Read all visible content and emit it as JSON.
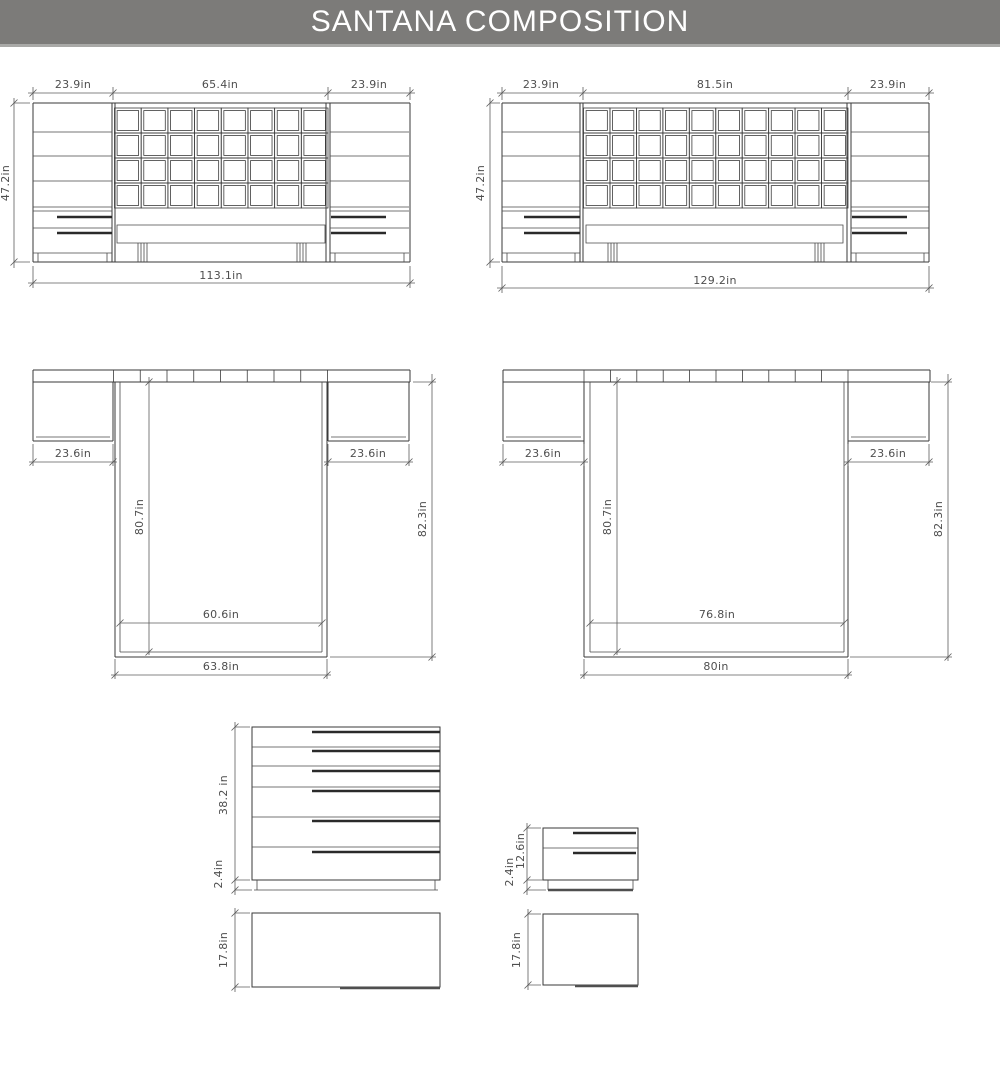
{
  "header": {
    "title": "SANTANA COMPOSITION"
  },
  "colors": {
    "header_bg": "#7c7b79",
    "line": "#3a3a3a",
    "dim_text": "#4e4e4e"
  },
  "views": {
    "front_queen": {
      "label_nightstand_left": "23.9in",
      "label_headboard": "65.4in",
      "label_nightstand_right": "23.9in",
      "label_height": "47.2in",
      "label_total_width": "113.1in",
      "grid_cols": 8,
      "grid_rows": 4
    },
    "front_king": {
      "label_nightstand_left": "23.9in",
      "label_headboard": "81.5in",
      "label_nightstand_right": "23.9in",
      "label_height": "47.2in",
      "label_total_width": "129.2in",
      "grid_cols": 10,
      "grid_rows": 4
    },
    "top_queen": {
      "label_nightstand_left": "23.6in",
      "label_nightstand_right": "23.6in",
      "label_bed_length": "80.7in",
      "label_total_depth": "82.3in",
      "label_mattress_width": "60.6in",
      "label_frame_width": "63.8in",
      "slats": 8
    },
    "top_king": {
      "label_nightstand_left": "23.6in",
      "label_nightstand_right": "23.6in",
      "label_bed_length": "80.7in",
      "label_total_depth": "82.3in",
      "label_mattress_width": "76.8in",
      "label_frame_width": "80in",
      "slats": 10
    },
    "dresser_front": {
      "label_height": "38.2 in",
      "label_base": "2.4in",
      "drawer_count": 6
    },
    "dresser_top": {
      "label_depth": "17.8in"
    },
    "nightstand_front": {
      "label_height": "12.6in",
      "label_base": "2.4in",
      "drawer_count": 2
    },
    "nightstand_top": {
      "label_depth": "17.8in"
    }
  }
}
